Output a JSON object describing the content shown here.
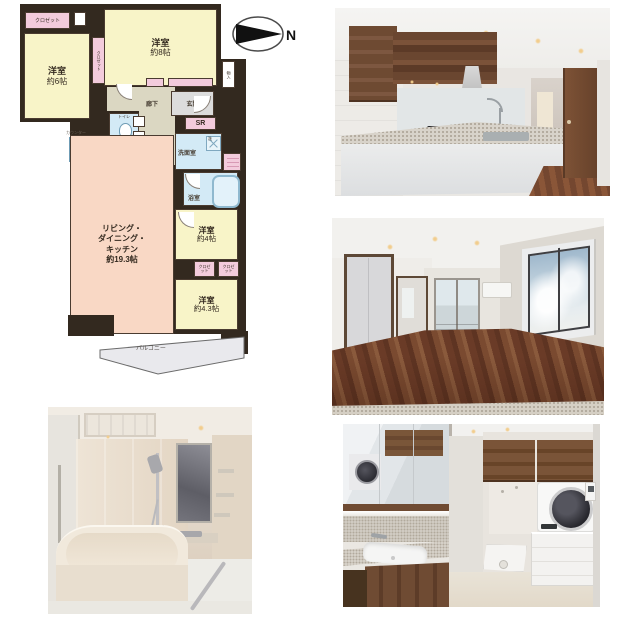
{
  "page": {
    "background": "#ffffff"
  },
  "floor_plan": {
    "compass_label": "N",
    "labels": {
      "closet": "クロゼット",
      "bedroom8_name": "洋室",
      "bedroom8_size": "約8帖",
      "bedroom6_name": "洋室",
      "bedroom6_size": "約6帖",
      "hallway": "廊下",
      "entrance": "玄関",
      "shoes_room": "SR",
      "storage": "物入",
      "toilet": "トイレ",
      "washroom": "洗面室",
      "laundry": "洗",
      "bathroom": "浴室",
      "counter": "カウンター",
      "ldk_line1": "リビング・",
      "ldk_line2": "ダイニング・",
      "ldk_line3": "キッチン",
      "ldk_line4": "約19.3帖",
      "bedroom4_name": "洋室",
      "bedroom4_size": "約4帖",
      "bedroom43_name": "洋室",
      "bedroom43_size": "約4.3帖",
      "balcony": "バルコニー"
    },
    "colors": {
      "wall": "#33291f",
      "room_yellow": "#f8f4c8",
      "room_pink": "#f3cbdc",
      "room_blue": "#d3eaf6",
      "ldk_salmon": "#f9d8c5",
      "corridor_beige": "#dbd7c2",
      "entrance_gray": "#dcdcdc",
      "balcony_gray": "#e9e9ed"
    }
  },
  "photos": {
    "colors": {
      "wood_cabinet": "#74503a",
      "wood_floor": "#7a4830",
      "granite": "#d9d4cb",
      "sky": "#c2d5e2",
      "bath_beige": "#e6dccf"
    }
  }
}
